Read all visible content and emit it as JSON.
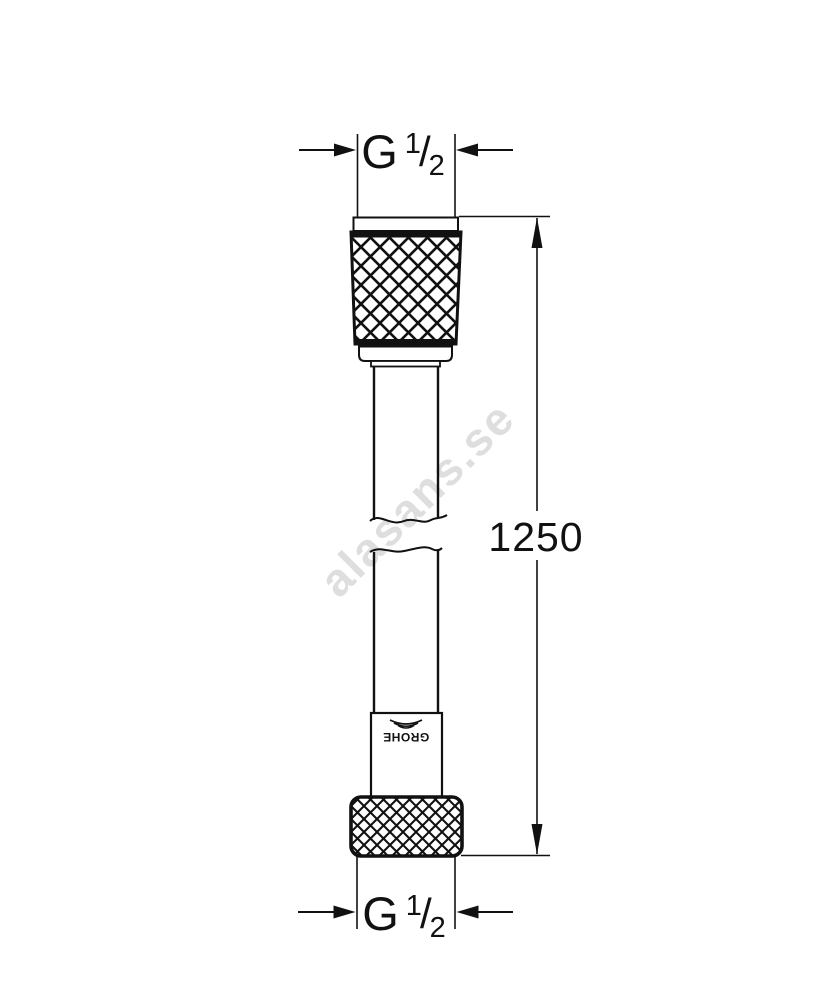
{
  "page": {
    "background": "#ffffff"
  },
  "watermark": {
    "text": "alasans.se",
    "color": "#dedede"
  },
  "drawing": {
    "type": "shower-hose-technical-drawing",
    "line_color": "#111111",
    "length_dimension": {
      "value": "1250"
    },
    "top_thread_dimension": {
      "g": "G",
      "numerator": "1",
      "slash": "/",
      "denominator": "2"
    },
    "bottom_thread_dimension": {
      "g": "G",
      "numerator": "1",
      "slash": "/",
      "denominator": "2"
    },
    "logo": {
      "text": "GROHE"
    }
  }
}
